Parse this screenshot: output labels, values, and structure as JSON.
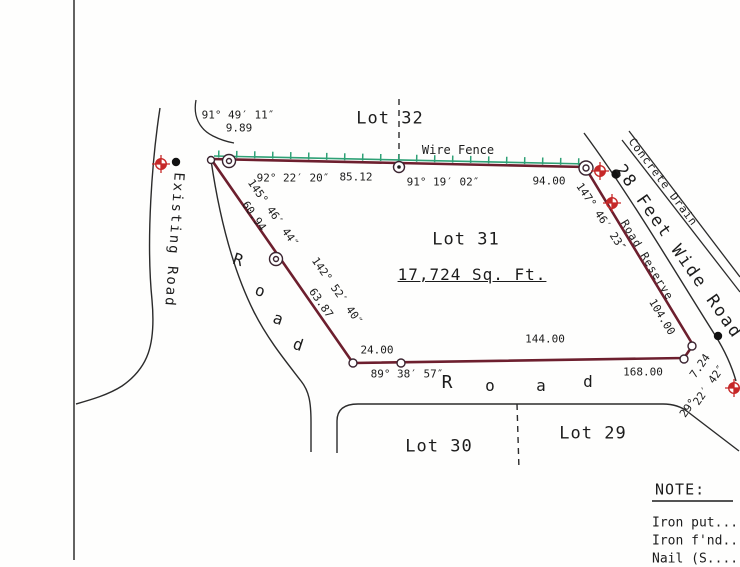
{
  "lots": {
    "lot31": "Lot 31",
    "lot31_area": "17,724 Sq. Ft.",
    "lot32": "Lot 32",
    "lot30": "Lot 30",
    "lot29": "Lot 29"
  },
  "roads": {
    "existing_road": "Existing Road",
    "wide_road": "28 Feet Wide Road",
    "road_reserve": "Road Reserve",
    "concrete_drain": "Concrete Drain",
    "wire_fence": "Wire Fence",
    "road_left_letters": [
      "R",
      "o",
      "a",
      "d"
    ],
    "road_bottom_letters": [
      "R",
      "o",
      "a",
      "d"
    ]
  },
  "measurements": {
    "nw_angle": "91° 49′ 11″",
    "nw_dist": "9.89",
    "top1_angle": "92° 22′ 20″",
    "top1_dist": "85.12",
    "top2_angle": "91° 19′ 02″",
    "top2_dist": "94.00",
    "ne_angle": "147° 46′ 23″",
    "west1_angle": "145° 46′ 44″",
    "west1_dist": "60.94",
    "west2_angle": "142° 52′ 40″",
    "west2_dist": "63.87",
    "sw_dist": "24.00",
    "sw_angle": "89° 38′ 57″",
    "south_dist": "144.00",
    "south_total": "168.00",
    "east_dist": "104.00",
    "se_dist": "7.24",
    "se_angle_deg": "29°",
    "se_angle_min": "22′ 42″"
  },
  "note": {
    "title": "NOTE:",
    "items": [
      "Iron put....",
      "Iron f'nd..",
      "Nail (S...."
    ]
  },
  "colors": {
    "boundary": "#6d1f2e",
    "fence": "#2fa176",
    "monument": "#c62828",
    "ink": "#2b2b2b",
    "text": "#1c1c1c"
  }
}
